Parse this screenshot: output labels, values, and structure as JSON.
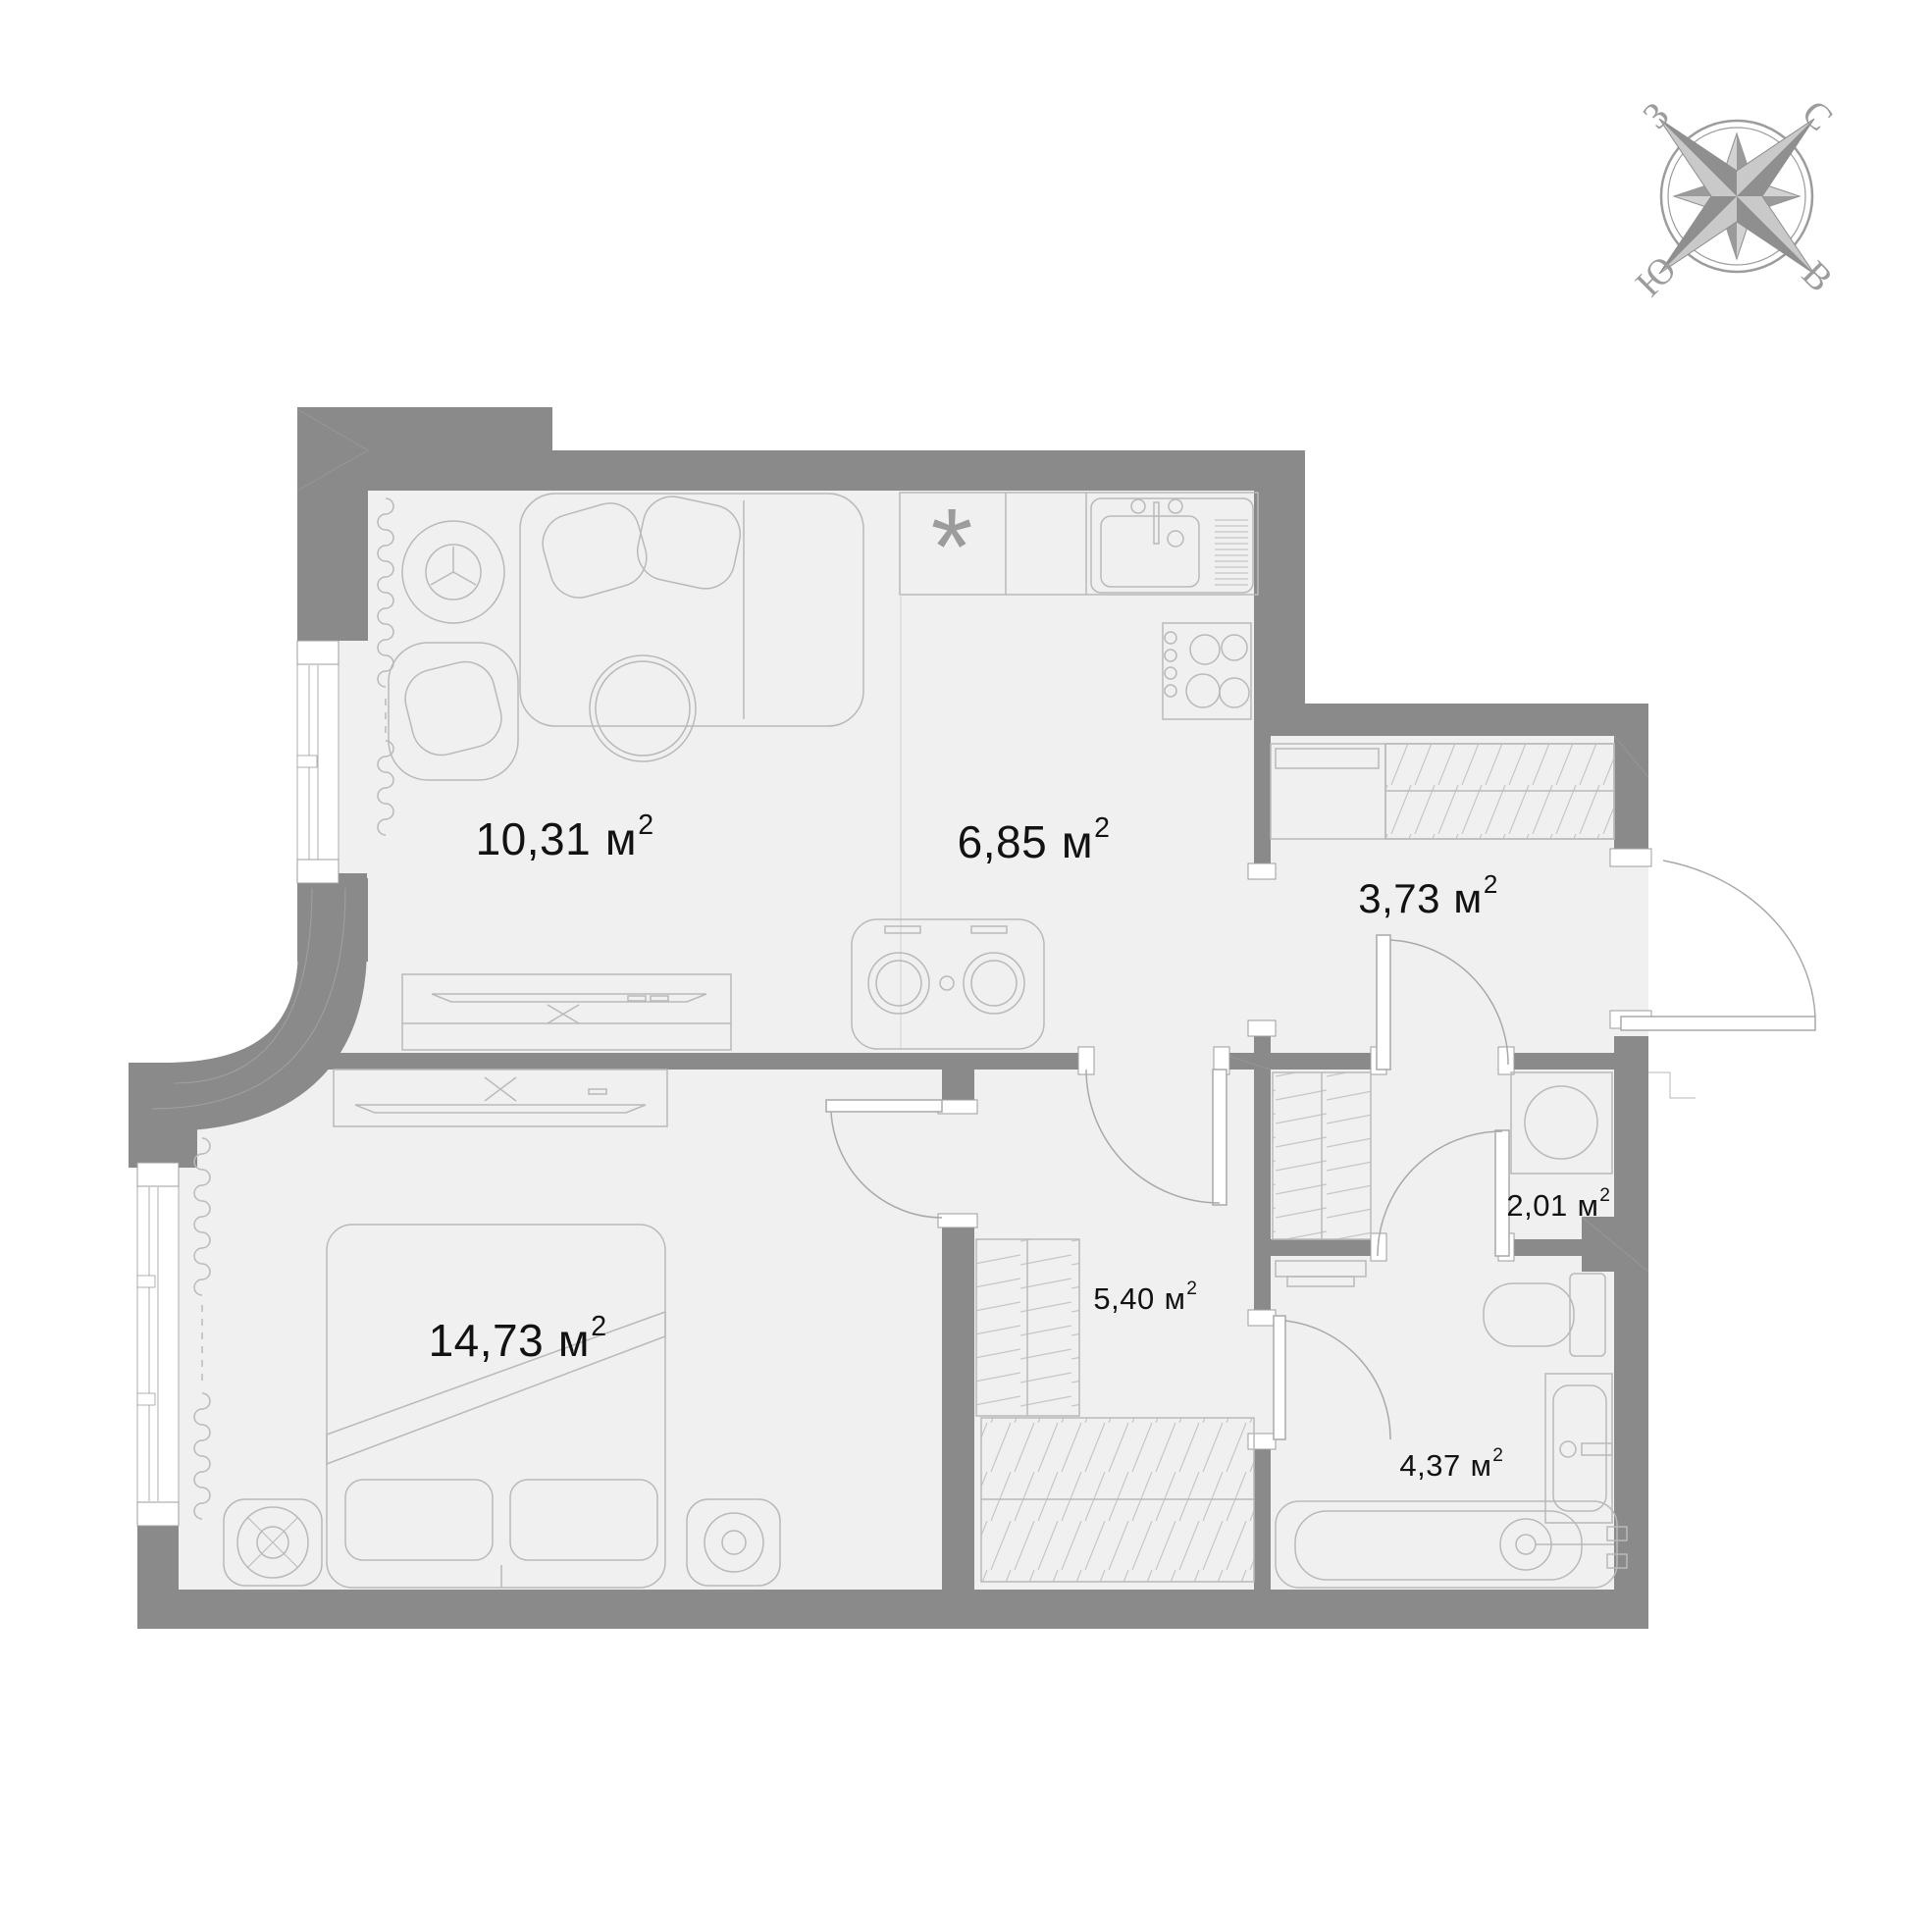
{
  "compass": {
    "north": "С",
    "east": "В",
    "south": "Ю",
    "west": "З"
  },
  "unit": "м",
  "unit_sup": "2",
  "kitchen_marker": "*",
  "rooms": [
    {
      "name": "living-room",
      "area": "10,31"
    },
    {
      "name": "kitchen",
      "area": "6,85"
    },
    {
      "name": "hallway",
      "area": "3,73"
    },
    {
      "name": "utility",
      "area": "2,01"
    },
    {
      "name": "corridor",
      "area": "5,40"
    },
    {
      "name": "bedroom",
      "area": "14,73"
    },
    {
      "name": "bathroom",
      "area": "4,37"
    }
  ],
  "colors": {
    "wall": "#8a8a8a",
    "floor": "#f0f0f1",
    "furniture_line": "#b9b9b9",
    "label": "#121212",
    "compass": "#9c9c9c"
  }
}
